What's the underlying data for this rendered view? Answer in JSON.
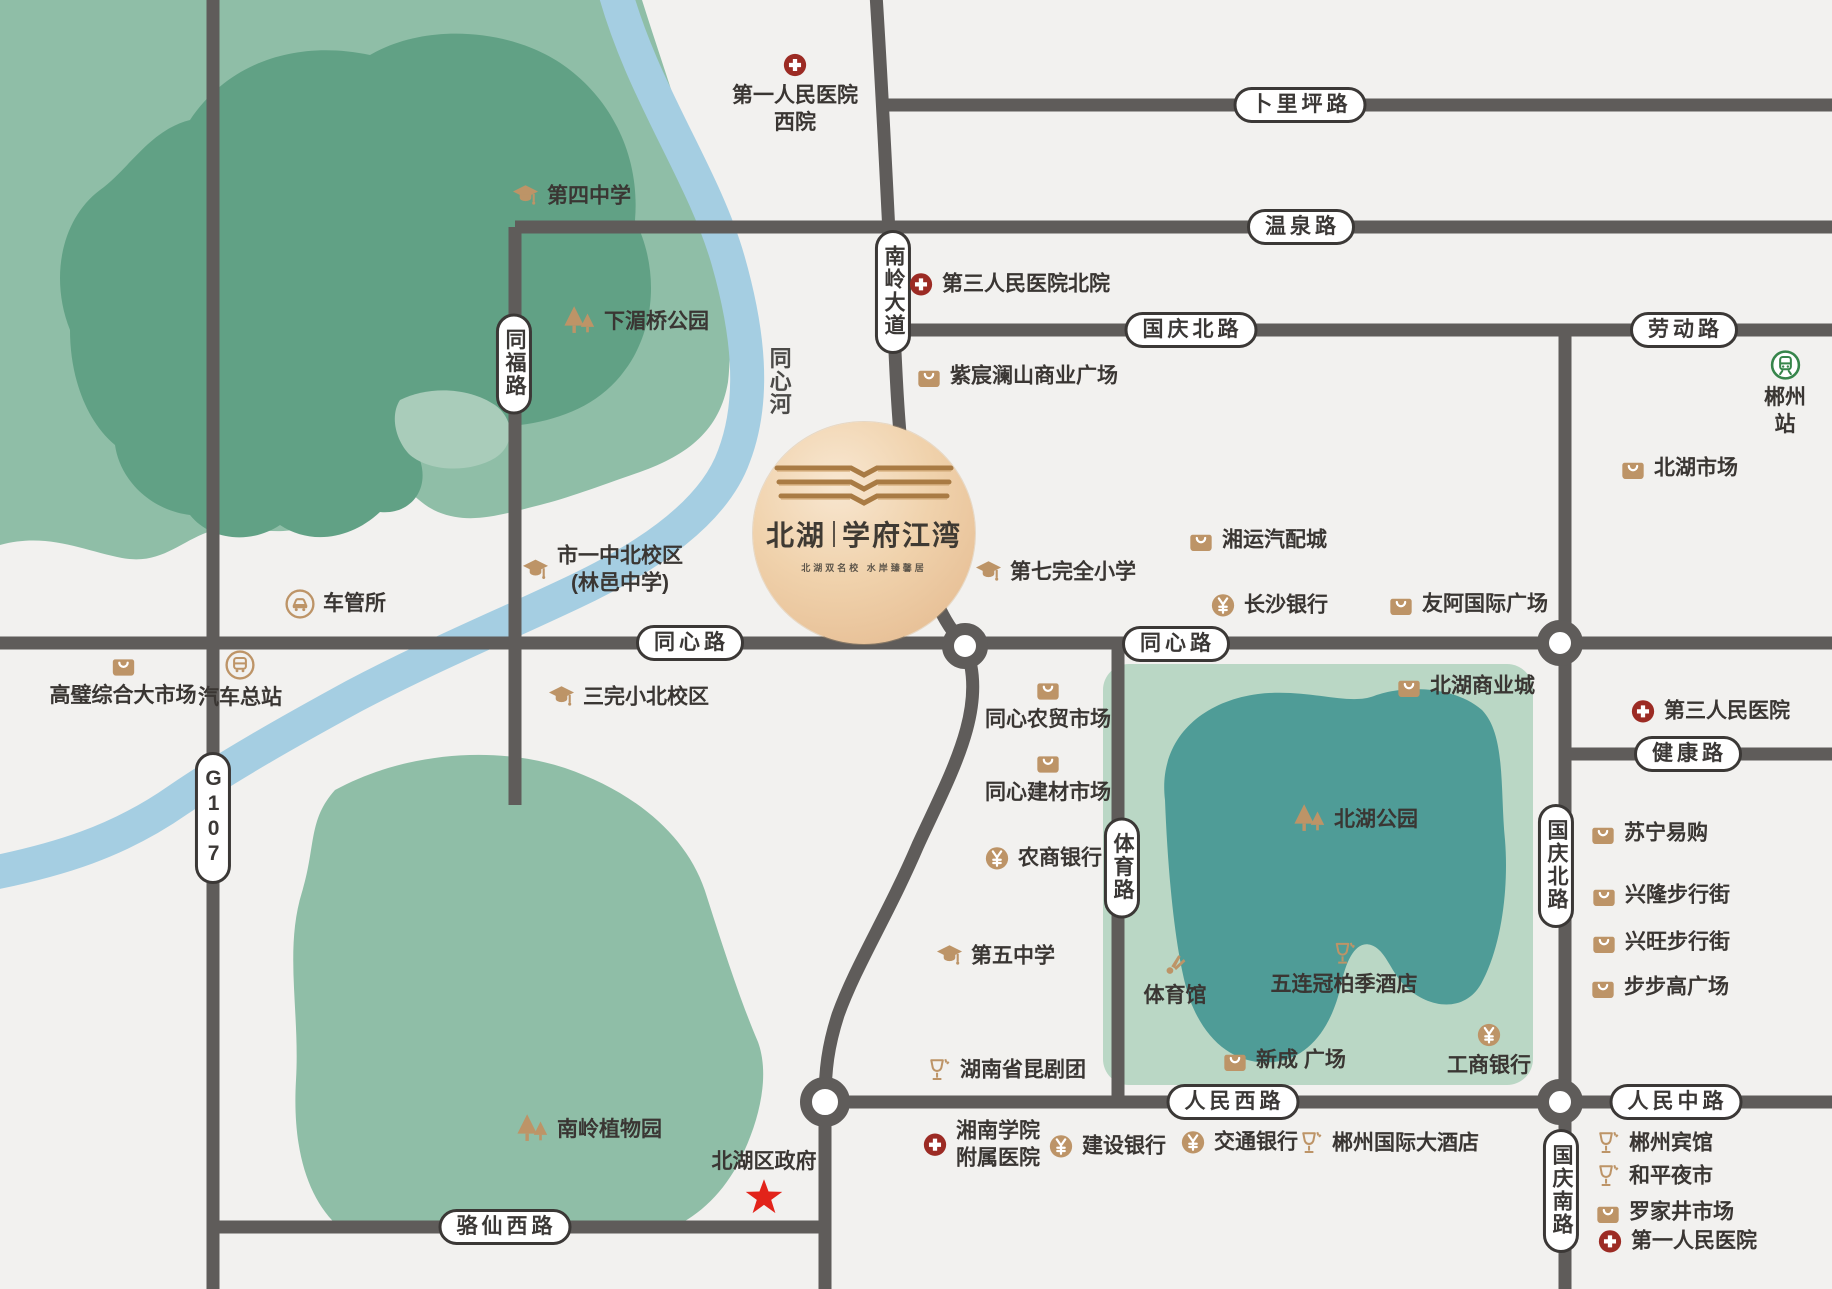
{
  "colors": {
    "background": "#f2f1ef",
    "road": "#5f5c5a",
    "park_outer_green": "#8fbea7",
    "park_inner_green": "#61a185",
    "park_light_patch": "#a9ccba",
    "river_blue": "#a5cee2",
    "lake_rect_green": "#bad7c5",
    "lake_teal": "#4f9c97",
    "poi_tan": "#bd9467",
    "hospital_red": "#9c2b24",
    "star_red": "#e2231a",
    "train_green": "#37854b",
    "label_dark": "#3a3633"
  },
  "logo": {
    "name_part1": "北湖",
    "divider": "|",
    "name_part2": "学府江湾",
    "tagline": "北湖双名校  水岸臻馨居"
  },
  "road_labels": [
    {
      "text": "卜里坪路",
      "x": 1300,
      "y": 105,
      "vertical": false,
      "plain": false
    },
    {
      "text": "温泉路",
      "x": 1301,
      "y": 227,
      "vertical": false,
      "plain": false
    },
    {
      "text": "国庆北路",
      "x": 1191,
      "y": 330,
      "vertical": false,
      "plain": false
    },
    {
      "text": "劳动路",
      "x": 1684,
      "y": 330,
      "vertical": false,
      "plain": false
    },
    {
      "text": "同心路",
      "x": 690,
      "y": 643,
      "vertical": false,
      "plain": false
    },
    {
      "text": "同心路",
      "x": 1176,
      "y": 644,
      "vertical": false,
      "plain": false
    },
    {
      "text": "健康路",
      "x": 1688,
      "y": 754,
      "vertical": false,
      "plain": false
    },
    {
      "text": "人民西路",
      "x": 1233,
      "y": 1102,
      "vertical": false,
      "plain": false
    },
    {
      "text": "人民中路",
      "x": 1676,
      "y": 1102,
      "vertical": false,
      "plain": false
    },
    {
      "text": "骆仙西路",
      "x": 505,
      "y": 1227,
      "vertical": false,
      "plain": false
    },
    {
      "text": "G107",
      "x": 213,
      "y": 818,
      "vertical": true,
      "plain": false
    },
    {
      "text": "同福路",
      "x": 514,
      "y": 364,
      "vertical": true,
      "plain": false
    },
    {
      "text": "南岭大道",
      "x": 893,
      "y": 292,
      "vertical": true,
      "plain": false
    },
    {
      "text": "体育路",
      "x": 1122,
      "y": 868,
      "vertical": true,
      "plain": false
    },
    {
      "text": "国庆北路",
      "x": 1556,
      "y": 866,
      "vertical": true,
      "plain": false
    },
    {
      "text": "国庆南路",
      "x": 1561,
      "y": 1191,
      "vertical": true,
      "plain": false
    },
    {
      "text": "同心河",
      "x": 778,
      "y": 382,
      "vertical": true,
      "plain": true
    }
  ],
  "pois": [
    {
      "type": "hospital",
      "layout": "col",
      "x": 795,
      "y": 52,
      "text": "第一人民医院\n西院"
    },
    {
      "type": "school",
      "layout": "row",
      "x": 512,
      "y": 196,
      "text": "第四中学"
    },
    {
      "type": "trees",
      "layout": "row",
      "x": 562,
      "y": 322,
      "text": "下湄桥公园"
    },
    {
      "type": "hospital",
      "layout": "row",
      "x": 908,
      "y": 284,
      "text": "第三人民医院北院"
    },
    {
      "type": "bag",
      "layout": "row",
      "x": 916,
      "y": 376,
      "text": "紫宸澜山商业广场"
    },
    {
      "type": "bag",
      "layout": "row",
      "x": 1620,
      "y": 468,
      "text": "北湖市场"
    },
    {
      "type": "train",
      "layout": "col",
      "x": 1785,
      "y": 350,
      "text": "郴州站"
    },
    {
      "type": "school",
      "layout": "row",
      "x": 522,
      "y": 570,
      "text": "市一中北校区\n(林邑中学)"
    },
    {
      "type": "car",
      "layout": "row",
      "x": 285,
      "y": 604,
      "text": "车管所"
    },
    {
      "type": "school",
      "layout": "row",
      "x": 975,
      "y": 572,
      "text": "第七完全小学"
    },
    {
      "type": "bag",
      "layout": "row",
      "x": 1188,
      "y": 540,
      "text": "湘运汽配城"
    },
    {
      "type": "yen",
      "layout": "row",
      "x": 1210,
      "y": 605,
      "text": "长沙银行"
    },
    {
      "type": "bag",
      "layout": "row",
      "x": 1388,
      "y": 604,
      "text": "友阿国际广场"
    },
    {
      "type": "bag",
      "layout": "col",
      "x": 123,
      "y": 652,
      "text": "高璧综合大市场"
    },
    {
      "type": "bus",
      "layout": "col",
      "x": 240,
      "y": 650,
      "text": "汽车总站"
    },
    {
      "type": "school",
      "layout": "row",
      "x": 548,
      "y": 697,
      "text": "三完小北校区"
    },
    {
      "type": "bag",
      "layout": "row",
      "x": 1396,
      "y": 686,
      "text": "北湖商业城"
    },
    {
      "type": "hospital",
      "layout": "row",
      "x": 1630,
      "y": 711,
      "text": "第三人民医院"
    },
    {
      "type": "bag",
      "layout": "col",
      "x": 1048,
      "y": 676,
      "text": "同心农贸市场"
    },
    {
      "type": "bag",
      "layout": "col",
      "x": 1048,
      "y": 749,
      "text": "同心建材市场"
    },
    {
      "type": "yen",
      "layout": "row",
      "x": 984,
      "y": 858,
      "text": "农商银行"
    },
    {
      "type": "trees",
      "layout": "row",
      "x": 1292,
      "y": 820,
      "text": "北湖公园"
    },
    {
      "type": "bag",
      "layout": "row",
      "x": 1590,
      "y": 833,
      "text": "苏宁易购"
    },
    {
      "type": "bag",
      "layout": "row",
      "x": 1591,
      "y": 895,
      "text": "兴隆步行街"
    },
    {
      "type": "bag",
      "layout": "row",
      "x": 1591,
      "y": 942,
      "text": "兴旺步行街"
    },
    {
      "type": "bag",
      "layout": "row",
      "x": 1590,
      "y": 987,
      "text": "步步高广场"
    },
    {
      "type": "school",
      "layout": "row",
      "x": 936,
      "y": 956,
      "text": "第五中学"
    },
    {
      "type": "shuttle",
      "layout": "col",
      "x": 1175,
      "y": 952,
      "text": "体育馆"
    },
    {
      "type": "goblet",
      "layout": "col",
      "x": 1344,
      "y": 940,
      "text": "五连冠柏季酒店"
    },
    {
      "type": "bag",
      "layout": "row",
      "x": 1222,
      "y": 1060,
      "text": "新成 广场"
    },
    {
      "type": "yen",
      "layout": "col",
      "x": 1489,
      "y": 1022,
      "text": "工商银行"
    },
    {
      "type": "goblet",
      "layout": "row",
      "x": 925,
      "y": 1070,
      "text": "湖南省昆剧团"
    },
    {
      "type": "trees",
      "layout": "row",
      "x": 515,
      "y": 1130,
      "text": "南岭植物园"
    },
    {
      "type": "star",
      "layout": "col-rev",
      "x": 764,
      "y": 1148,
      "text": "北湖区政府"
    },
    {
      "type": "hospital",
      "layout": "row",
      "x": 922,
      "y": 1145,
      "text": "湘南学院\n附属医院"
    },
    {
      "type": "yen",
      "layout": "row",
      "x": 1048,
      "y": 1146,
      "text": "建设银行"
    },
    {
      "type": "yen",
      "layout": "row",
      "x": 1180,
      "y": 1142,
      "text": "交通银行"
    },
    {
      "type": "goblet",
      "layout": "row",
      "x": 1297,
      "y": 1143,
      "text": "郴州国际大酒店"
    },
    {
      "type": "goblet",
      "layout": "row",
      "x": 1594,
      "y": 1143,
      "text": "郴州宾馆"
    },
    {
      "type": "goblet",
      "layout": "row",
      "x": 1594,
      "y": 1176,
      "text": "和平夜市"
    },
    {
      "type": "bag",
      "layout": "row",
      "x": 1595,
      "y": 1212,
      "text": "罗家井市场"
    },
    {
      "type": "hospital",
      "layout": "row",
      "x": 1597,
      "y": 1241,
      "text": "第一人民医院"
    }
  ]
}
